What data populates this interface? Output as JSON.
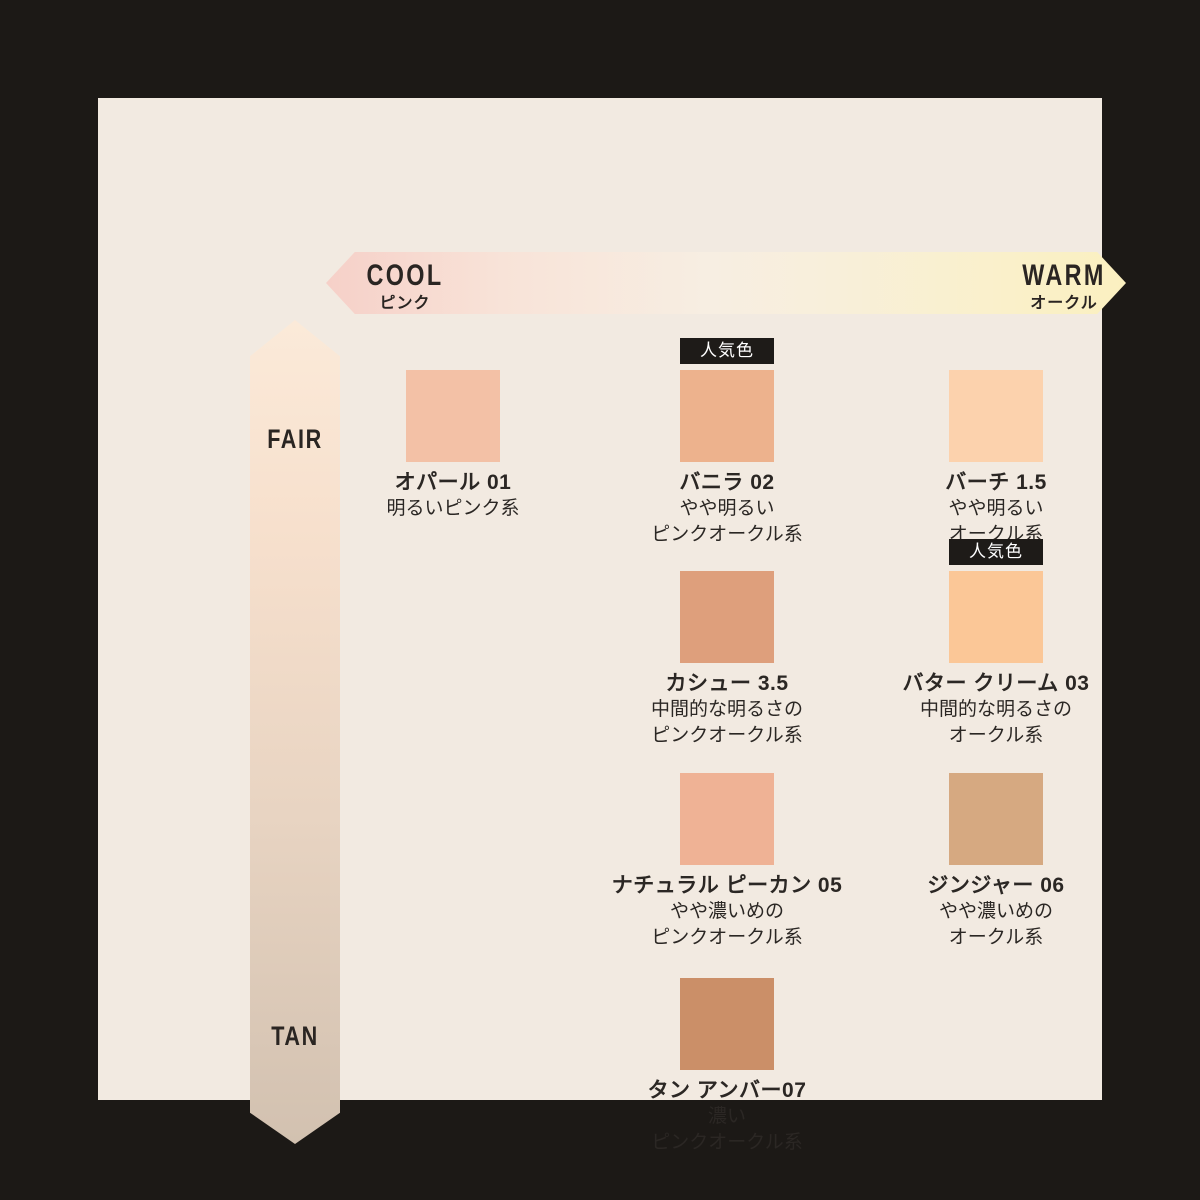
{
  "palette": {
    "page_background": "#1c1916",
    "panel_background": "#f2eae1",
    "text_color": "#2b2724",
    "badge_background": "#1e1b18",
    "badge_text_color": "#ffffff"
  },
  "axes": {
    "horizontal": {
      "left_label": "COOL",
      "left_sublabel": "ピンク",
      "right_label": "WARM",
      "right_sublabel": "オークル",
      "gradient_left": "#f6d0c8",
      "gradient_right": "#fbf0c0"
    },
    "vertical": {
      "top_label": "FAIR",
      "bottom_label": "TAN",
      "gradient_top": "#fbead9",
      "gradient_bottom": "#d2c1b0"
    }
  },
  "badge_label": "人気色",
  "shades": [
    {
      "name": "オパール 01",
      "desc": [
        "明るいピンク系"
      ],
      "color": "#f3c1a6",
      "popular": false
    },
    {
      "name": "バニラ 02",
      "desc": [
        "やや明るい",
        "ピンクオークル系"
      ],
      "color": "#edb28d",
      "popular": true
    },
    {
      "name": "バーチ 1.5",
      "desc": [
        "やや明るい",
        "オークル系"
      ],
      "color": "#fcd2ad",
      "popular": false
    },
    {
      "name": "カシュー 3.5",
      "desc": [
        "中間的な明るさの",
        "ピンクオークル系"
      ],
      "color": "#de9f7c",
      "popular": false
    },
    {
      "name": "バター クリーム 03",
      "desc": [
        "中間的な明るさの",
        "オークル系"
      ],
      "color": "#fbc797",
      "popular": true
    },
    {
      "name": "ナチュラル ピーカン 05",
      "desc": [
        "やや濃いめの",
        "ピンクオークル系"
      ],
      "color": "#efb295",
      "popular": false
    },
    {
      "name": "ジンジャー 06",
      "desc": [
        "やや濃いめの",
        "オークル系"
      ],
      "color": "#d6a981",
      "popular": false
    },
    {
      "name": "タン アンバー07",
      "desc": [
        "濃い",
        "ピンクオークル系"
      ],
      "color": "#cb8f68",
      "popular": false
    }
  ]
}
